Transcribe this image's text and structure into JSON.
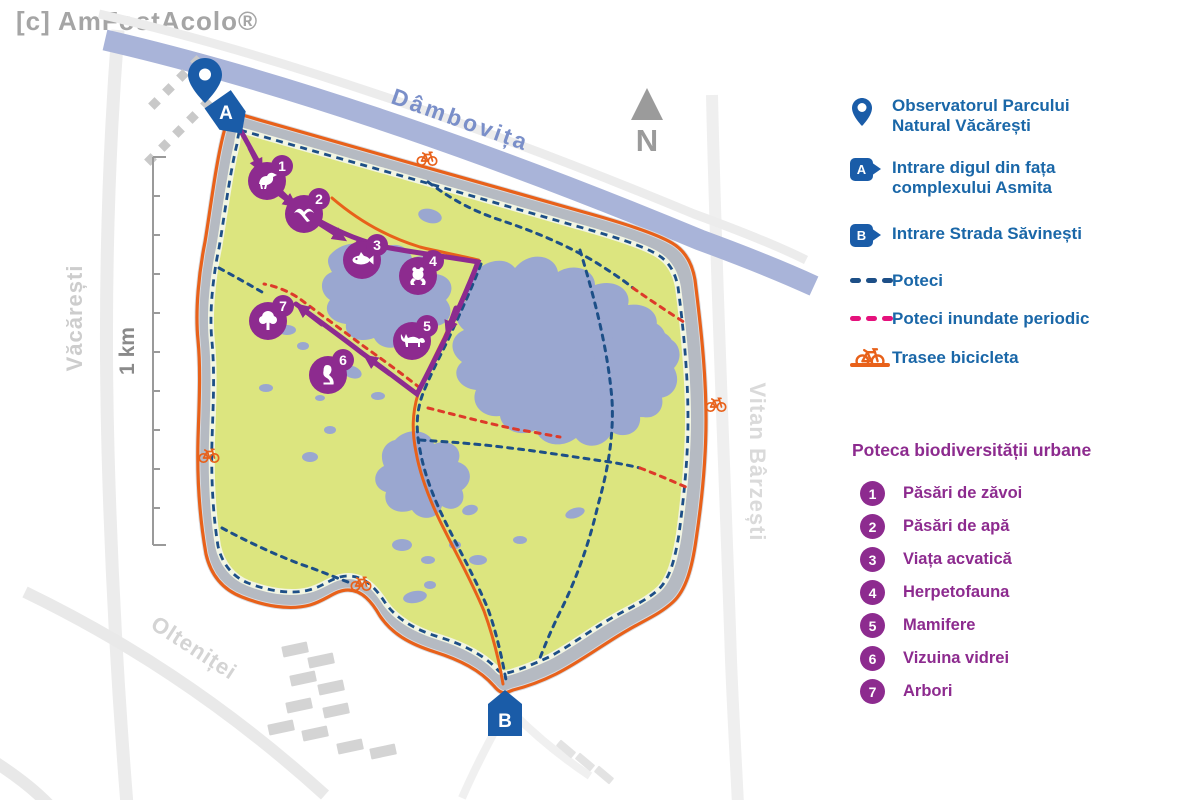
{
  "watermark": "[c] AmFostAcolo®",
  "map": {
    "river_label": "Dâmbovița",
    "north_label": "N",
    "scale_label": "1 km",
    "streets": {
      "left": "Văcărești",
      "bottom": "Olteniței",
      "right": "Vitan Bârzești"
    },
    "entrance_a": "A",
    "entrance_b": "B"
  },
  "legend": {
    "badge_a": "A",
    "badge_b": "B",
    "observatory": "Observatorul Parcului Natural Văcărești",
    "entrance_a": "Intrare digul din fața complexului Asmita",
    "entrance_b": "Intrare Strada Săvinești",
    "paths": "Poteci",
    "flooded": "Poteci inundate periodic",
    "bike": "Trasee bicicleta"
  },
  "trail": {
    "title": "Poteca biodiversității urbane",
    "items": [
      {
        "number": "1",
        "label": "Păsări de zăvoi",
        "icon": "bird"
      },
      {
        "number": "2",
        "label": "Păsări de apă",
        "icon": "flying-bird"
      },
      {
        "number": "3",
        "label": "Viața acvatică",
        "icon": "fish"
      },
      {
        "number": "4",
        "label": "Herpetofauna",
        "icon": "frog"
      },
      {
        "number": "5",
        "label": "Mamifere",
        "icon": "fox"
      },
      {
        "number": "6",
        "label": "Vizuina vidrei",
        "icon": "otter"
      },
      {
        "number": "7",
        "label": "Arbori",
        "icon": "tree"
      }
    ]
  },
  "colors": {
    "text_blue": "#1a67a8",
    "marker_blue": "#1a5ca8",
    "trail_purple": "#8d2b8f",
    "bike_orange": "#e8611a",
    "path_blue": "#1d4f87",
    "flooded_pink": "#e5117c",
    "flooded_red_map": "#dd3a2a",
    "park_green": "#dce57f",
    "lake_blue": "#9aa7d0",
    "river_blue": "#a9b4d9",
    "dike_gray": "#b5bac2"
  }
}
